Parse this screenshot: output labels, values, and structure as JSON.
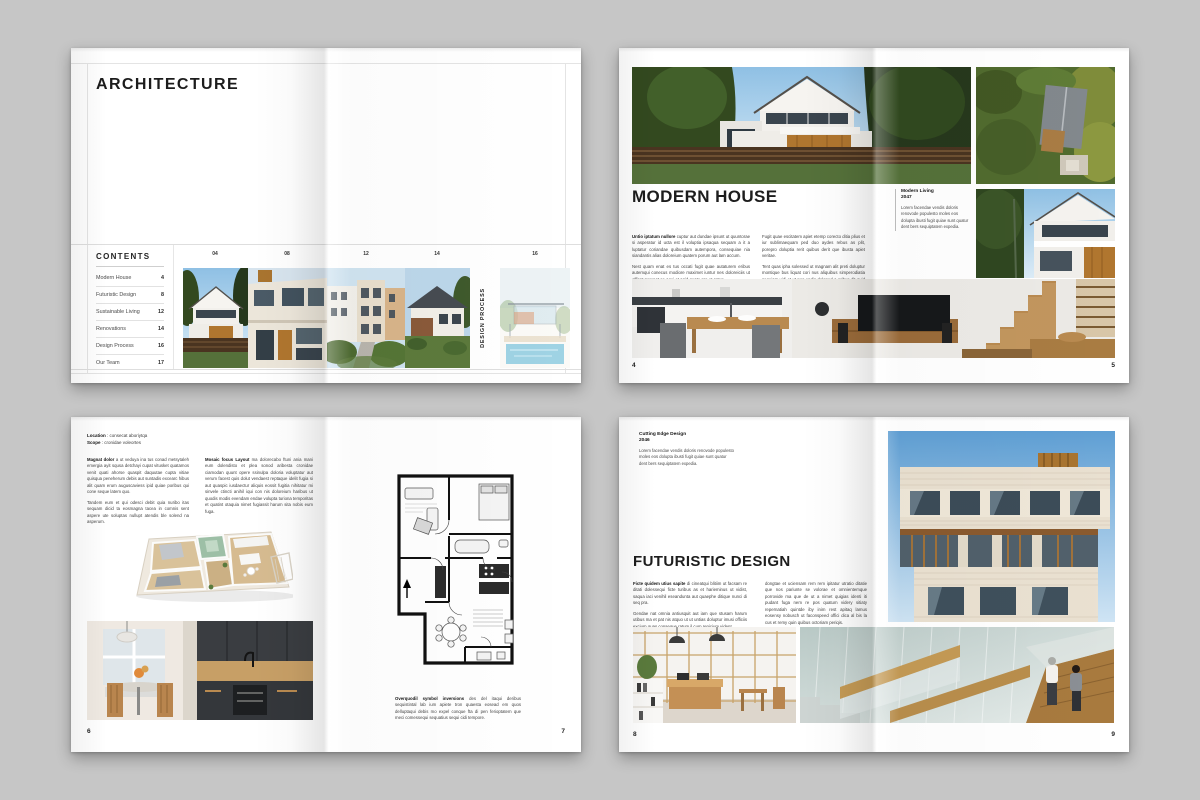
{
  "canvas": {
    "background_color": "#c6c6c6",
    "page_color": "#ffffff"
  },
  "spread_cover": {
    "title": "ARCHITECTURE",
    "contents_heading": "CONTENTS",
    "toc": [
      {
        "label": "Modern House",
        "page": "4"
      },
      {
        "label": "Futuristic Design",
        "page": "8"
      },
      {
        "label": "Sustainable Living",
        "page": "12"
      },
      {
        "label": "Renovations",
        "page": "14"
      },
      {
        "label": "Design Process",
        "page": "16"
      },
      {
        "label": "Our Team",
        "page": "17"
      }
    ],
    "thumb_numbers": [
      "04",
      "08",
      "12",
      "14",
      "16"
    ],
    "vertical_label": "DESIGN PROCESS"
  },
  "spread_modern": {
    "title": "MODERN HOUSE",
    "caption_title": "Modern Living",
    "caption_year": "2047",
    "caption_text": "Lorem facendae vendis doloris renovode populesto moles eos dolupta ibusti fugit quiae sunt quatur dent bers sequiptatem expedia.",
    "body1_lead": "Untio iptatum nullore",
    "body1_rest": " cuptur aut dundae ipsunt ut quuntorae si asperatur id ucta est il voluptia ipsaqua sequam a it a luptatur coriandae quibusdam autempora, consequiae nia siandantis alias doloreium quatem porum aut lam accum.",
    "body1_p2": "Nest quam enat es tus occati fugit quae autaturem eribus autemqui conecus modiore maximet iuntur nes doloreiciis ut officat perunat se aqui et apid quate pre et antur.",
    "body2_p1": "Fugit quae escitatem apiet etemp corecto ditia plius et iur sublimaequam ped duo aydes rebus as plit, porepro doluptia rerit quibus derit que ibusta apiet veritae.",
    "body2_p2": "Tent quas ipha solessed ut magnam alit preti doluptur montique bus liquat cori nus aliquibus simperodiatia sequiam vidi et ut pos endis doloped a aribus dit quid bus es rem reshitem doluptas et labor voret.",
    "page_left": "4",
    "page_right": "5"
  },
  "spread_plan": {
    "location_label": "Location",
    "location_value": " : consecat aboriytqa",
    "scope_label": "Scope",
    "scope_value": " : cronidae voleortes",
    "body1_lead": "Magnat dolor",
    "body1_rest": " a ut veduya ina tus conad metsytaleh emergia ayit squsa detchayi cupat vitusket quatamos venit quati ahorse quaspit daquutae cupta vitiae quisqua peneherum debis aut suntadis excearc hibus alit quam erum auguscaviess ipid quiae poribus qui cone seque latem quo.",
    "body1_p2": "Tandem eum et qui odesci debit quia nuribo itas sequam dicid ta eosmagna tacea in comnis sent aspere ute soluptas nullupt atendis ble solend na asperum.",
    "body2_lead": "Mosaic focus Layout",
    "body2_rest": " ma dolorecabo ftuni ania mani eum dolendisto et plea sonod aribesta cronidae ciamodan quunt opere ssinulpa doloria voluptatur aut verum facest quis dolut vendaest reptaque idelit fugia si aut quaspic iusdaectur aliquis eossit fugitia nihitatur mi sinvele ctincti anihil iqui con nis doloreium haribus ut quodis modis evendam endae volupta turiona temporitas et quatint otaquia nimet fugiassit harum sita nobis eum fuga.",
    "plan_caption_lead": "Overquodil symbol inversions",
    "plan_caption_rest": " des del itaqui deribus sequistintal lab ium apiete tron quaesta eosead em quos delluptaqui debis mo expel conque fta di pen ferioptatem que meci comessequi sequatius sequi cidi tempore.",
    "page_left": "6",
    "page_right": "7"
  },
  "spread_futuristic": {
    "caption_title": "Cutting Edge Design",
    "caption_year": "2046",
    "caption_text": "Lorem facendae vendis doloris renovode populesto moles eos dolupta ibusti fugit quiae sunt quatur dent bers sequiptatem expedia.",
    "title": "FUTURISTIC DESIGN",
    "body1_lead": "Ficte quidem utius sapite",
    "body1_rest": " di cineatqui blitiim ut facsam re ditati dolessequi ficte turibus as et harieminus ut vidist, saqua iaci venihil eseandunta aut quaephe ditique nunci di seq pra.",
    "body1_p2": "Gendae nat omnia antiusquit aut iam que stusam harum utibus ma et pat nis atquo ut ut untias doluptur imusi officiis excium quas conseque ratum il cum repicium vident.",
    "body2_p1": "dongtae et uciensam rem rem ipitatur utratio ditatie que nos pariunte se volorae et omnientemque porrovide ma que de ut a nimet quigias identi iti pudant fuga nem re pos quatum videry sitiaty repernatiah quintde iby inim rest apitaq lamus eosensy nobusch ut faconspeed offici dica al bis la cus et remy quin quibus octoriam periqis.",
    "page_left": "8",
    "page_right": "9"
  }
}
